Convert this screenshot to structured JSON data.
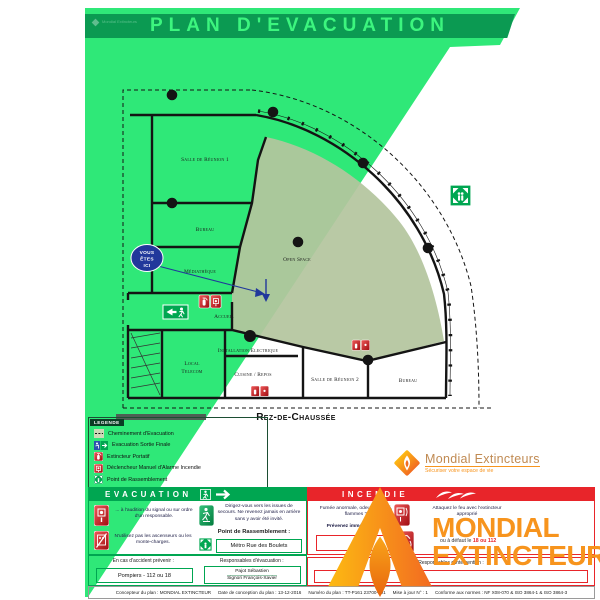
{
  "header": {
    "title": "PLAN D'EVACUATION"
  },
  "brand": {
    "name": "Mondial Extincteurs",
    "tagline": "Sécuriser votre espace de vie"
  },
  "watermark": {
    "line1": "MONDIAL",
    "line2": "EXTINCTEUR"
  },
  "plan": {
    "floor_label": "Rez-de-Chaussée",
    "you_are_here": {
      "line1": "VOUS",
      "line2": "ÊTES",
      "line3": "ICI"
    },
    "rooms": {
      "salle_reunion_1": "Salle de Réunion 1",
      "bureau_gauche": "Bureau",
      "mediatheque": "Médiathèque",
      "accueil": "Accueil",
      "installation_electrique": "Installation Electrique",
      "local_telecom_1": "Local",
      "local_telecom_2": "Telecom",
      "cuisine_repos": "Cuisine / Repos",
      "salle_reunion_2": "Salle de Réunion 2",
      "bureau_droit": "Bureau",
      "open_space": "Open Space"
    }
  },
  "legend": {
    "title": "LEGENDE",
    "items": [
      {
        "icon": "dashed-path-icon",
        "label": "Cheminement d'Evacuation"
      },
      {
        "icon": "exit-sign-icon",
        "label": "Evacuation Sortie Finale"
      },
      {
        "icon": "extinguisher-icon",
        "label": "Extincteur Portatif"
      },
      {
        "icon": "manual-alarm-icon",
        "label": "Déclencheur Manuel d'Alarme Incendie"
      },
      {
        "icon": "assembly-point-icon",
        "label": "Point de Rassemblement"
      }
    ]
  },
  "evacuation": {
    "title": "EVACUATION",
    "instruction_signal": "... à l'audition du signal ou sur ordre d'un responsable.",
    "instruction_exits": "Dirigez-vous vers les issues de secours. Ne revenez jamais en arrière sans y avoir été invité.",
    "instruction_lifts": "N'utilisez pas les ascenseurs ou les monte-charges.",
    "assembly_label": "Point de Rassemblement :",
    "assembly_value": "Métro Rue des Boulets",
    "accident_label": "En cas d'accident prévenir :",
    "accident_value": "Pompiers - 112 ou 18",
    "responsables_label": "Responsables d'évacuation :",
    "responsable_1": "Pajot Sébastien",
    "responsable_2": "Signori François-Xavier"
  },
  "incendie": {
    "title": "INCENDIE",
    "alert_text": "Fumée anormale, odeur de brûlé, flammes ?",
    "notify_text": "Prévenez immédiatement",
    "phone_value": "18",
    "fallback_prefix": "ou à défaut le ",
    "fallback_numbers": "18 ou 112",
    "attack_text": "Attaquez le feu avec l'extincteur approprié",
    "responsables_label": "Responsables d'intervention :"
  },
  "footer": {
    "parts": [
      "Concepteur du plan : MONDIAL EXTINCTEUR",
      "Date de conception du plan : 13-12-2016",
      "Numéro du plan : TT-P161 23700-101",
      "Mise à jour N° : 1",
      "Conforme aux normes : NF X08-070 & ISO 3864-1 & ISO 3864-3"
    ]
  },
  "colors": {
    "bright_green": "#2FE878",
    "dark_green_band": "#0B9A52",
    "safety_green": "#00A651",
    "safety_red": "#E8252A",
    "orange": "#F7941D",
    "navy": "#21389B",
    "sage": "#B5C4A0"
  }
}
